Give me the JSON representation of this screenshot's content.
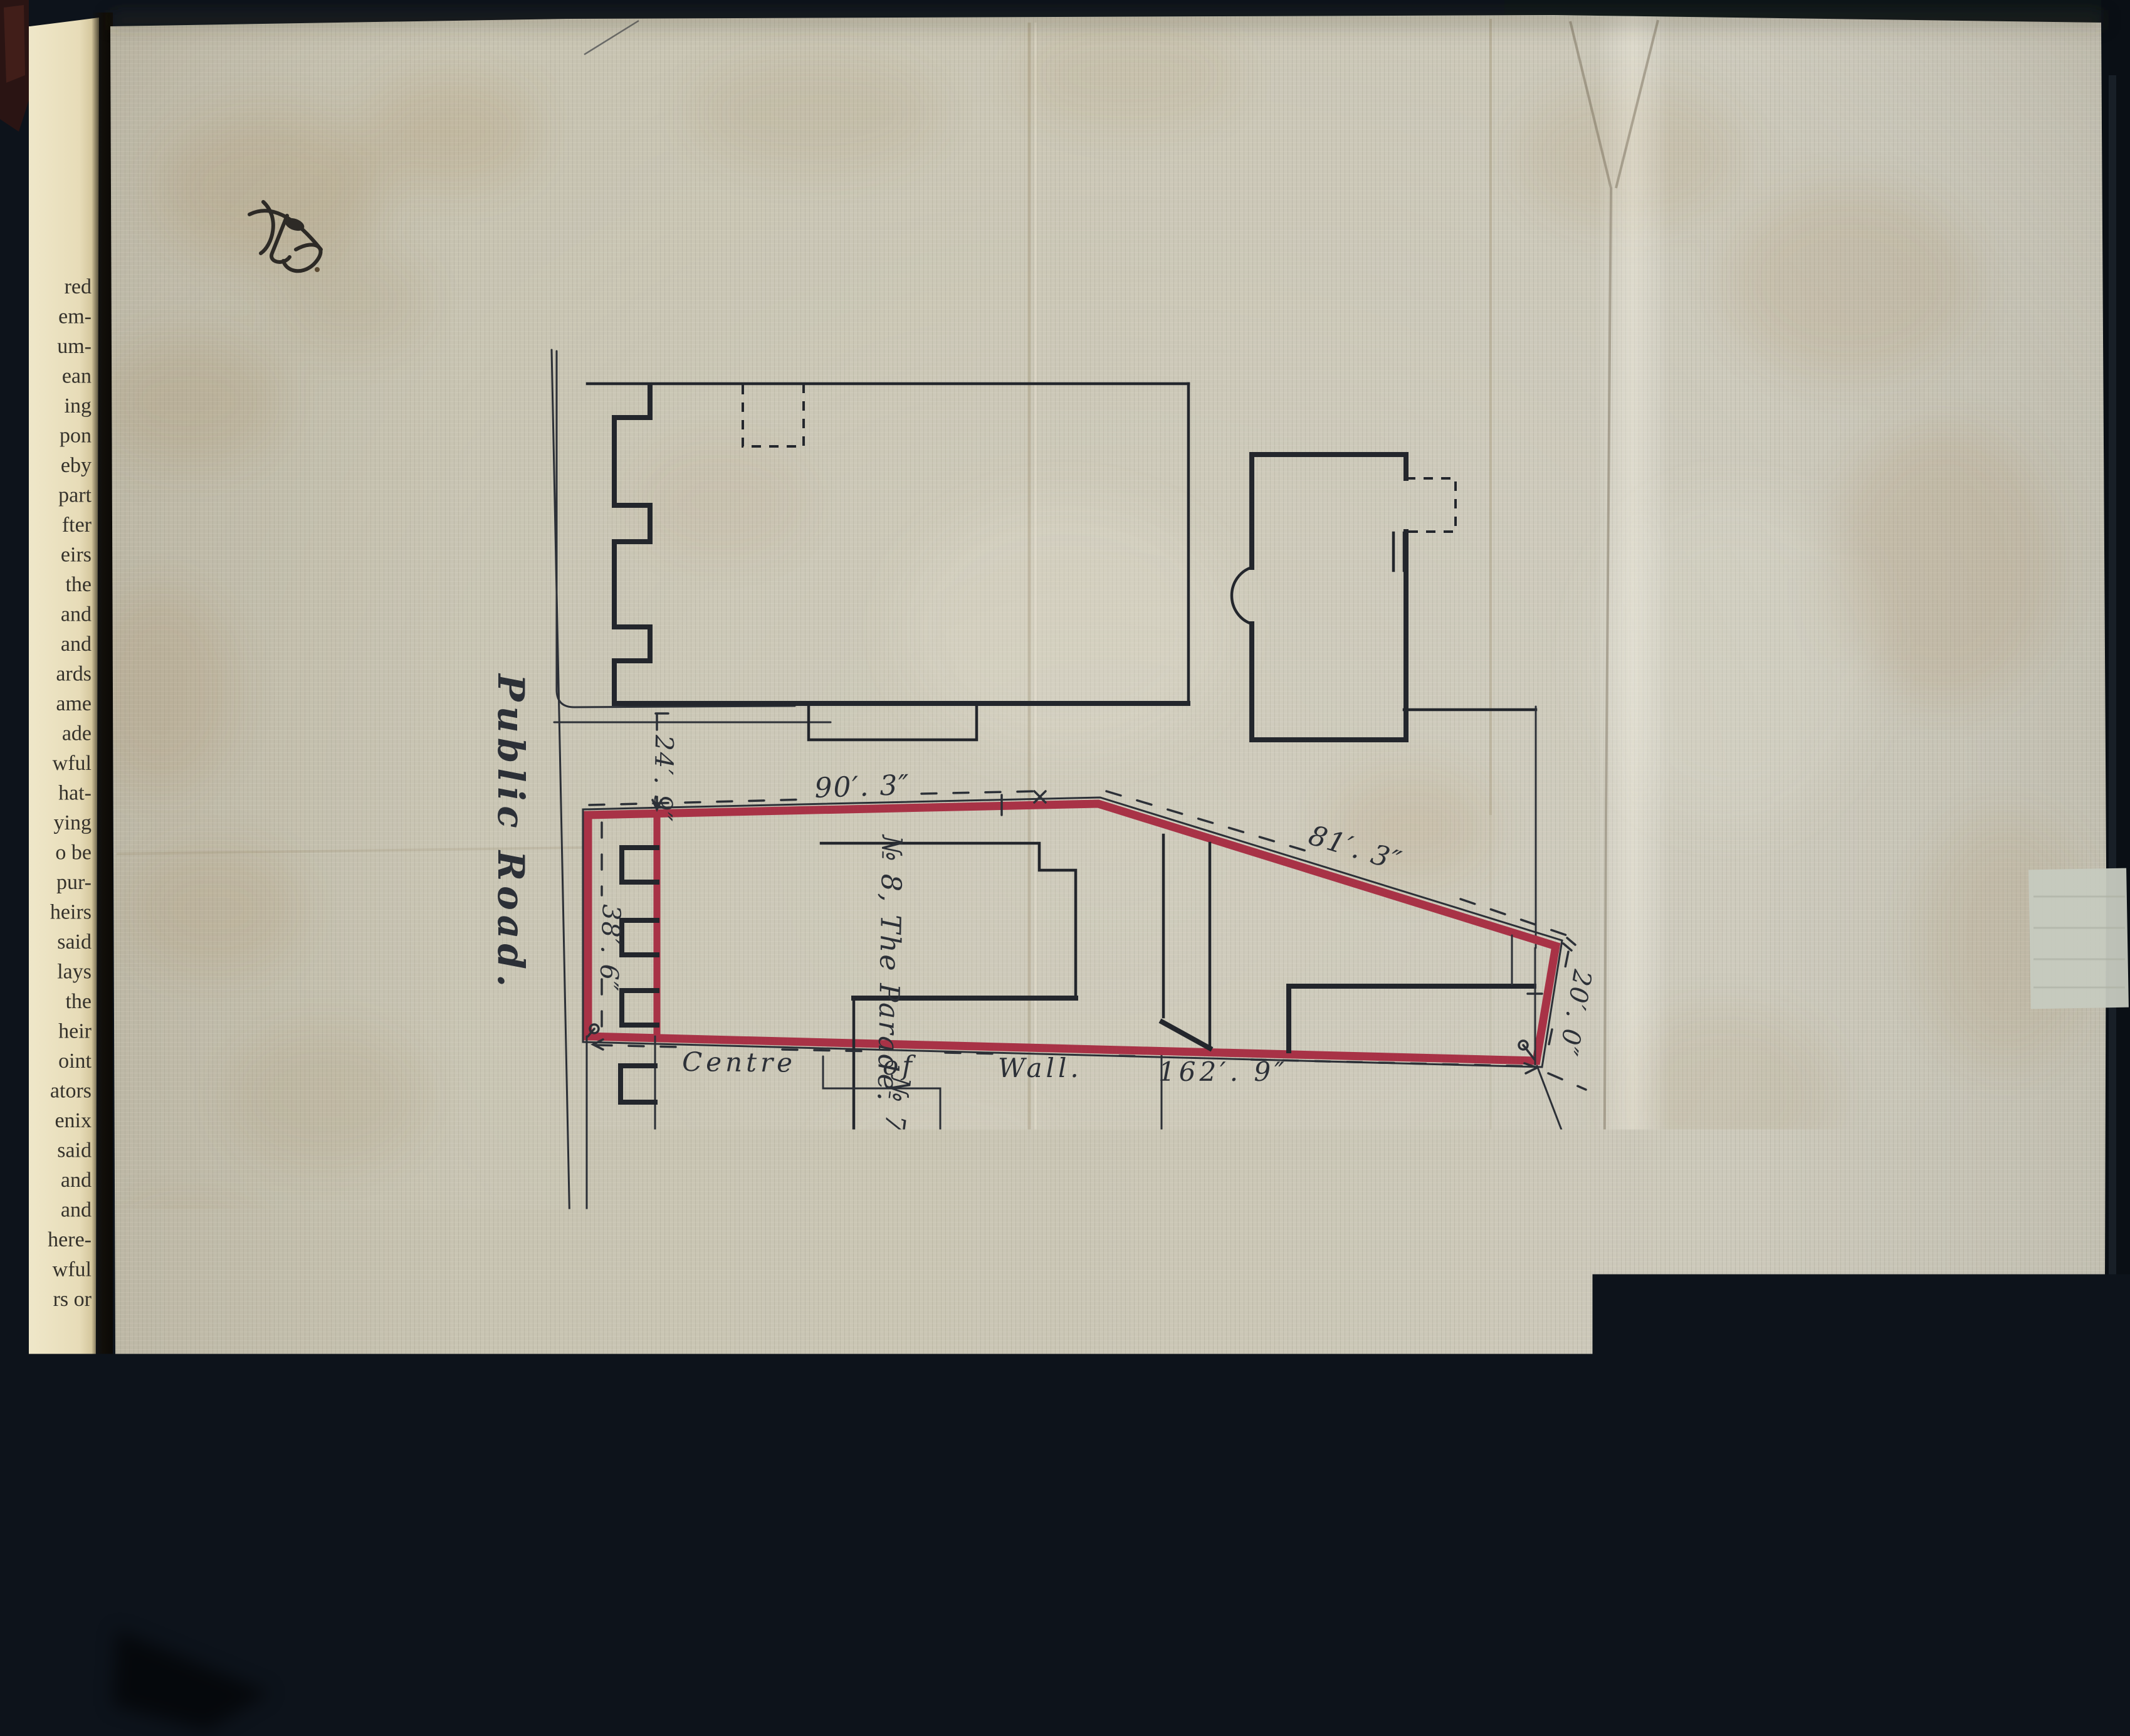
{
  "palette": {
    "background": "#0d131b",
    "sheet": "#c7c3b2",
    "book_page": "#ece3c4",
    "ink": "#2c3037",
    "building_ink": "#23262c",
    "parcel_red": "#a83246",
    "stain": "#a08253",
    "repair_patch": "#c6cabf"
  },
  "book_page": {
    "fragments": [
      "red",
      "em-",
      "um-",
      "ean",
      "ing",
      "pon",
      "eby",
      "part",
      "fter",
      "eirs",
      "the",
      "and",
      "and",
      "ards",
      "ame",
      "ade",
      "wful",
      "hat-",
      "ying",
      "o be",
      "pur-",
      "heirs",
      "said",
      "lays",
      "the",
      "heir",
      "oint",
      "ators",
      "enix",
      "said",
      "and",
      "and",
      "here-",
      "wful",
      "rs or"
    ]
  },
  "plan": {
    "road_label": "Public Road.",
    "no8_label": "№ 8, The Parade.",
    "no7_label": "№ 7, The Parade.",
    "dims": {
      "top": "90′. 3″",
      "diagonal": "81′. 3″",
      "right_end": "20′. 0″",
      "left_frontage": "38′. 6″",
      "road_width": "24′. 9″"
    },
    "wall_line": {
      "w1": "Centre",
      "w2": "of",
      "w3": "Wall.",
      "w4": "162′. 9″"
    }
  }
}
